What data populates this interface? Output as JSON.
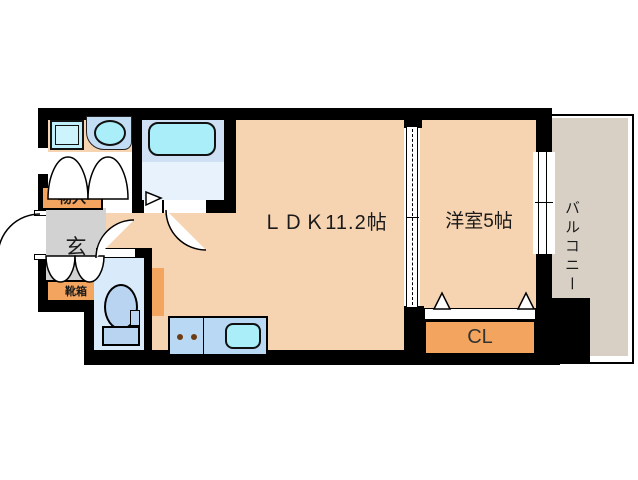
{
  "plan": {
    "rooms": {
      "ldk": "ＬＤＫ11.2帖",
      "western_room": "洋室5帖",
      "balcony": "バルコニー",
      "entrance": "玄",
      "storage": "物入",
      "shoe_cabinet": "靴箱",
      "closet": "CL"
    },
    "fixtures": [
      "bathtub",
      "wash-basin",
      "washing-machine-pan",
      "toilet",
      "kitchen-sink",
      "stove-burners"
    ],
    "colors": {
      "wall": "#000000",
      "floor_main": "#f6d3b1",
      "floor_balcony": "#d9d0c5",
      "floor_entrance": "#d2d2d2",
      "cabinet_orange": "#f3a45f",
      "wet_area_blue": "#d9eafa",
      "bath_floor_blue": "#e7f2fc",
      "fixture_cyan": "#a9eef8",
      "counter_blue": "#b9d8f4"
    }
  }
}
